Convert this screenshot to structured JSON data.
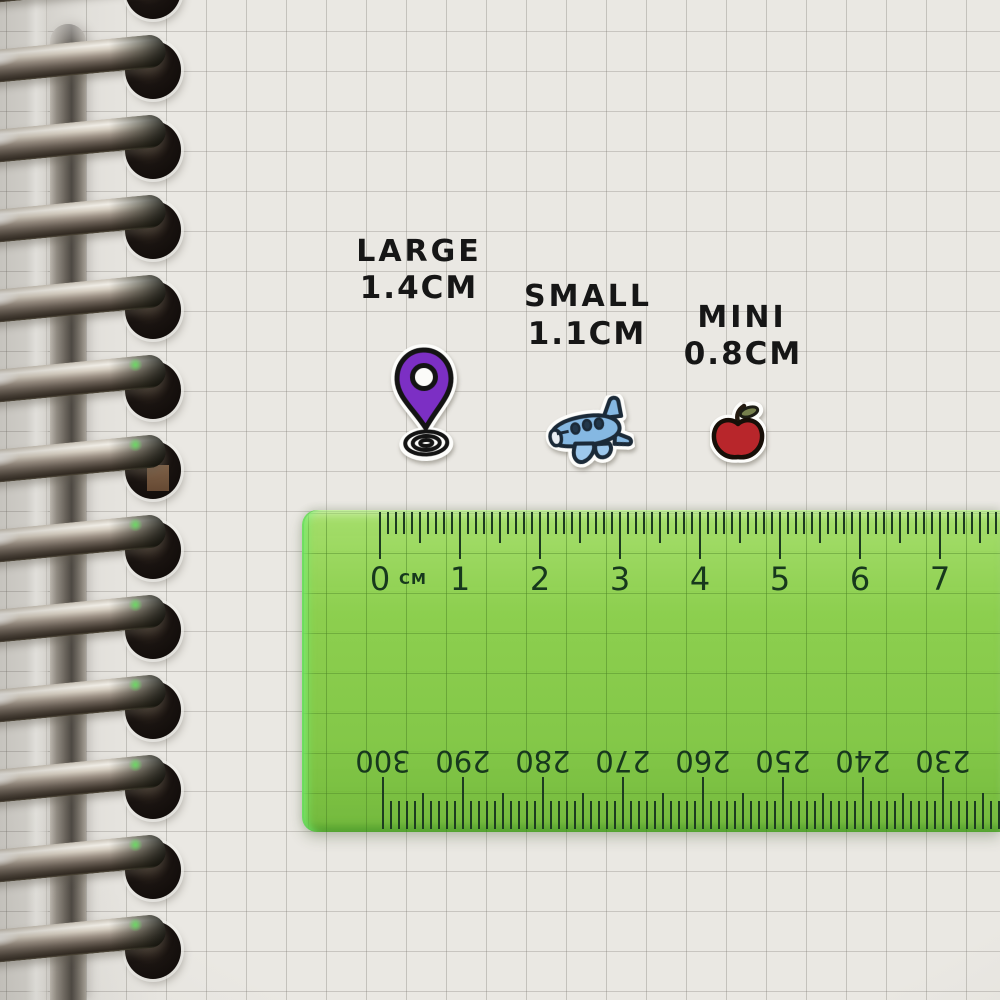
{
  "stickers": {
    "large": {
      "label": "LARGE",
      "size": "1.4CM",
      "icon": "location-pin-sticker",
      "color": "#7c2fc4"
    },
    "small": {
      "label": "SMALL",
      "size": "1.1CM",
      "icon": "airplane-sticker",
      "color": "#85b8e2"
    },
    "mini": {
      "label": "MINI",
      "size": "0.8CM",
      "icon": "apple-sticker",
      "color": "#b8262b"
    }
  },
  "ruler": {
    "unit": "CM",
    "top_numbers": [
      "0",
      "1",
      "2",
      "3",
      "4",
      "5",
      "6",
      "7"
    ],
    "bottom_numbers": [
      "300",
      "290",
      "280",
      "270",
      "260",
      "250",
      "240",
      "230"
    ],
    "body_color": "#84c74e",
    "tick_color": "#1c3b20"
  }
}
